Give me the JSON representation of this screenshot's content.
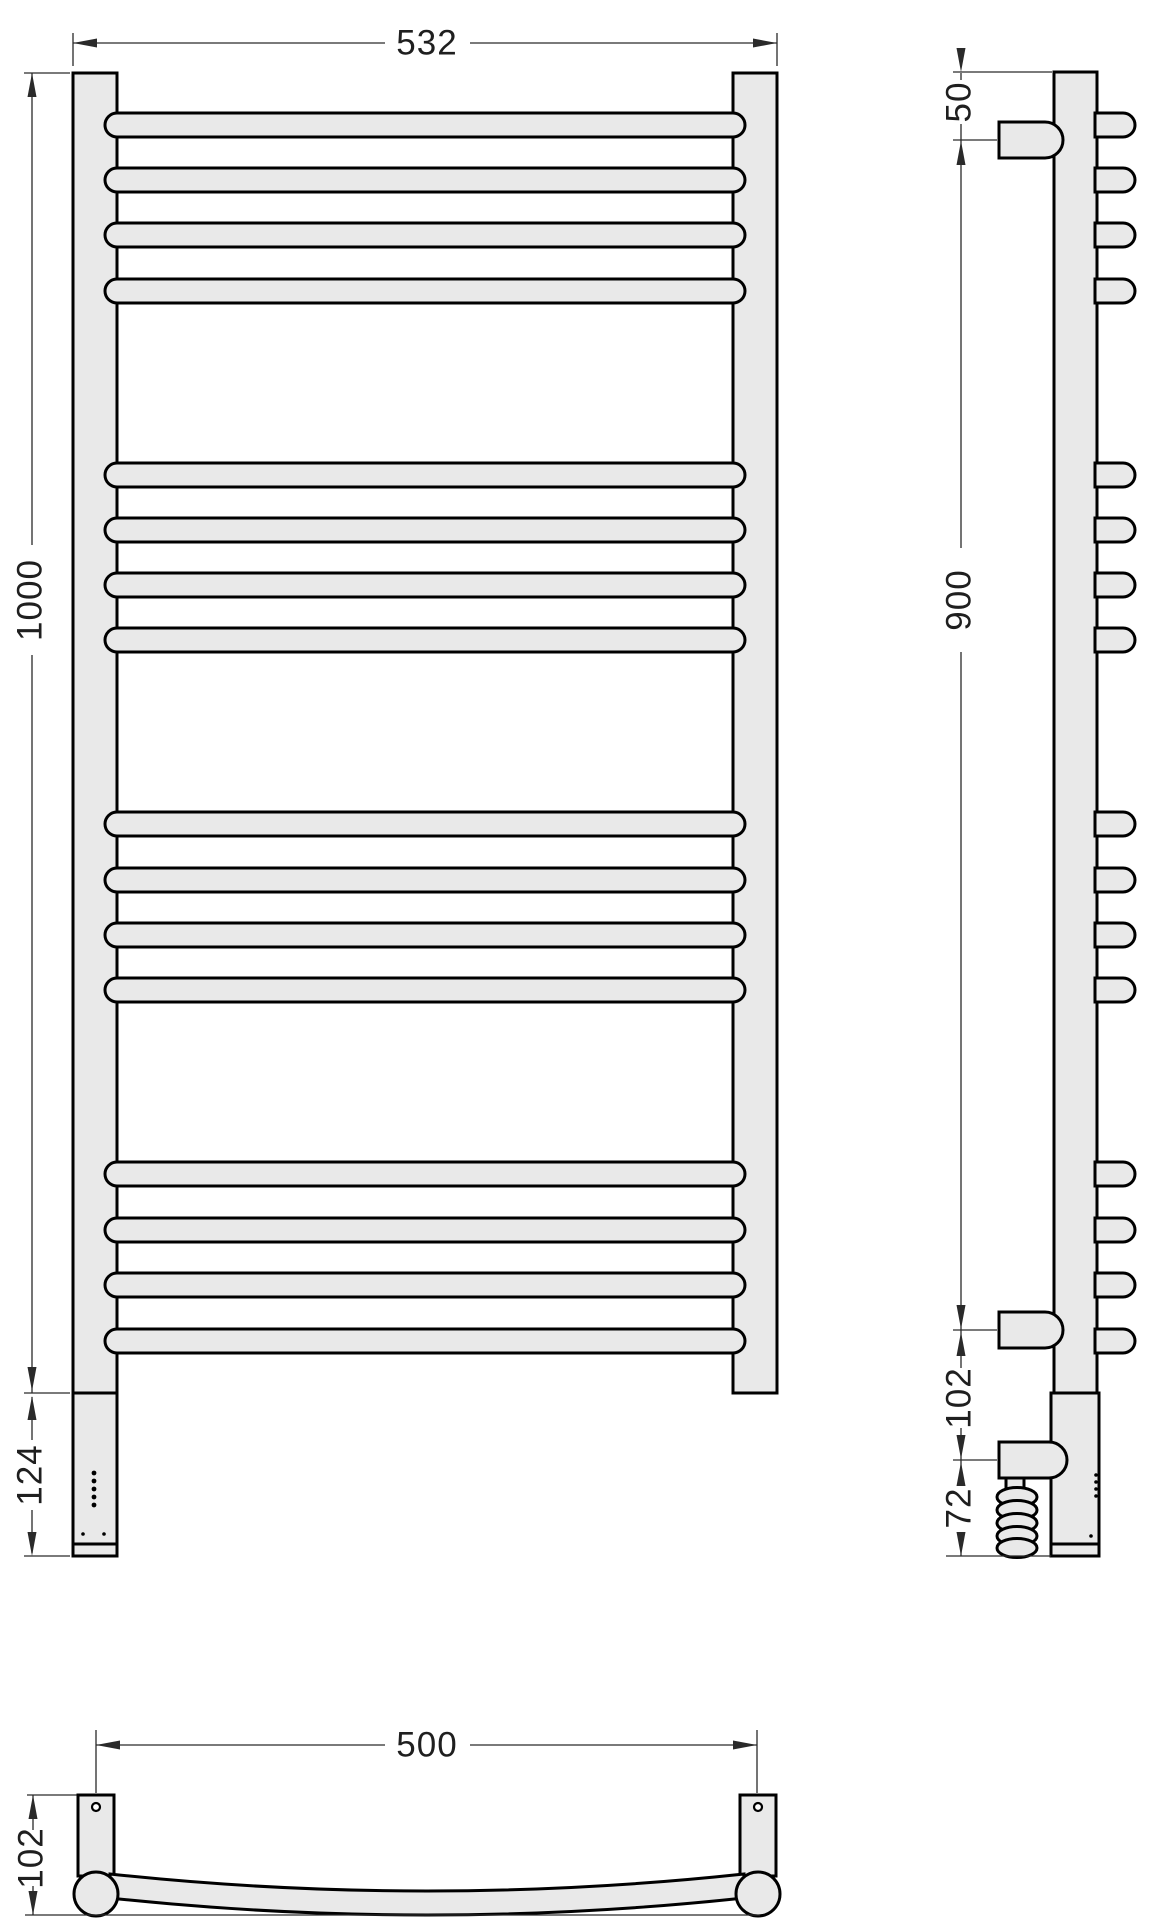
{
  "drawing_title": "heated-towel-rail-technical-drawing",
  "dimensions": {
    "front_width": "532",
    "front_height": "1000",
    "front_unit_height": "124",
    "side_top_offset": "50",
    "side_mount_span": "900",
    "side_lower_offset": "102",
    "side_plug_offset": "72",
    "bottom_mount_span": "500",
    "bottom_depth": "102"
  },
  "colors": {
    "body_fill": "#e9e9e9",
    "outline": "#000000",
    "dim_lines": "#2a2a2a",
    "background": "#ffffff"
  },
  "front_view": {
    "rung_tops": [
      113,
      168,
      223,
      279,
      463,
      518,
      573,
      628,
      812,
      868,
      923,
      978,
      1162,
      1218,
      1273,
      1329
    ],
    "rung_height": 24,
    "indicator_dot_ys": [
      1473,
      1481,
      1489,
      1497,
      1505
    ],
    "indicator_dot_x": 94,
    "screw_dots": [
      [
        83,
        1534
      ],
      [
        104,
        1534
      ]
    ]
  },
  "side_view": {
    "nub_tops": [
      113,
      168,
      223,
      279,
      463,
      518,
      573,
      628,
      812,
      868,
      923,
      978,
      1162,
      1218,
      1273,
      1329
    ],
    "nub_height": 24,
    "coil_loop_ys": [
      1497,
      1510,
      1523,
      1536,
      1548
    ],
    "edge_dot_ys": [
      1475,
      1482,
      1489,
      1496
    ],
    "edge_dot_x": 1096,
    "lower_dot": [
      1091,
      1536
    ]
  }
}
